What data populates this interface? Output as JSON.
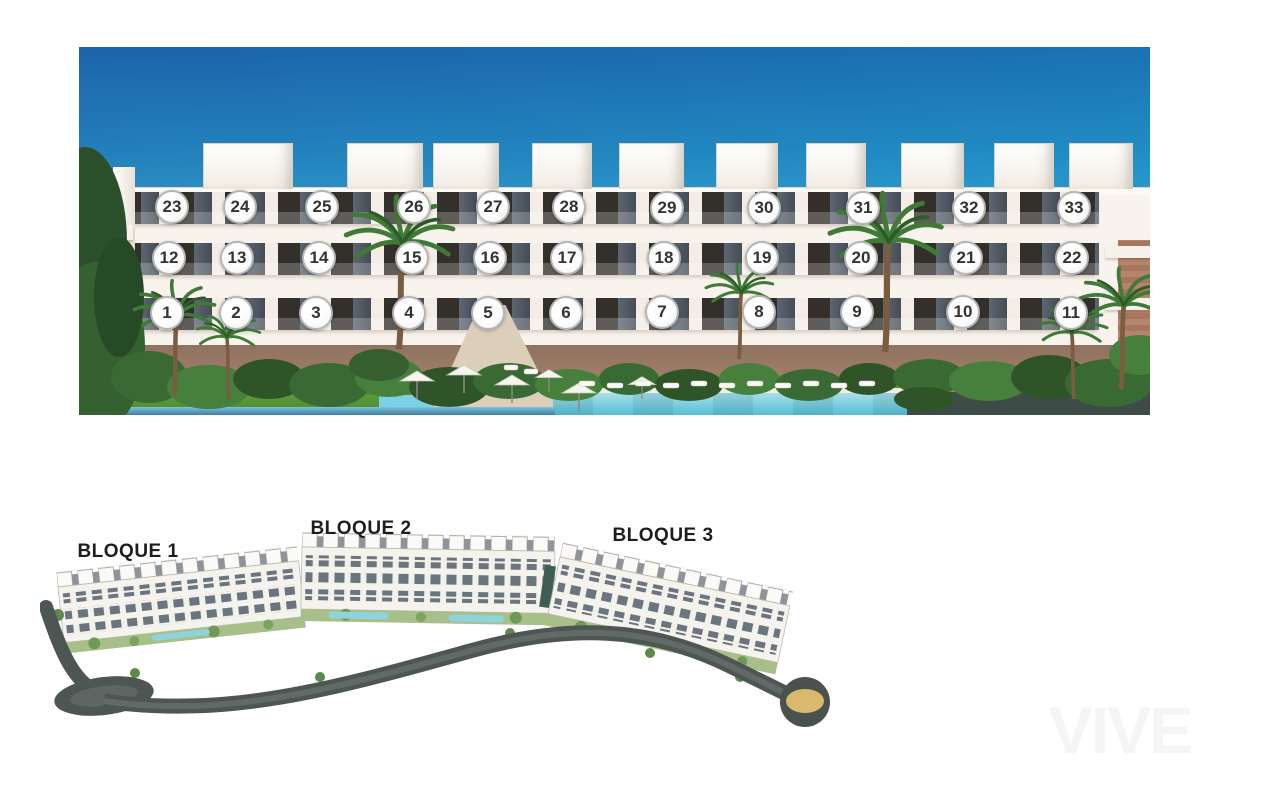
{
  "elevation": {
    "rows": [
      {
        "floor": "top",
        "units": [
          {
            "n": "23",
            "x": 93,
            "y": 160
          },
          {
            "n": "24",
            "x": 161,
            "y": 160
          },
          {
            "n": "25",
            "x": 243,
            "y": 160
          },
          {
            "n": "26",
            "x": 335,
            "y": 160
          },
          {
            "n": "27",
            "x": 414,
            "y": 160
          },
          {
            "n": "28",
            "x": 490,
            "y": 160
          },
          {
            "n": "29",
            "x": 588,
            "y": 161
          },
          {
            "n": "30",
            "x": 685,
            "y": 161
          },
          {
            "n": "31",
            "x": 784,
            "y": 161
          },
          {
            "n": "32",
            "x": 890,
            "y": 161
          },
          {
            "n": "33",
            "x": 995,
            "y": 161
          }
        ]
      },
      {
        "floor": "middle",
        "units": [
          {
            "n": "12",
            "x": 90,
            "y": 211
          },
          {
            "n": "13",
            "x": 158,
            "y": 211
          },
          {
            "n": "14",
            "x": 240,
            "y": 211
          },
          {
            "n": "15",
            "x": 333,
            "y": 211
          },
          {
            "n": "16",
            "x": 411,
            "y": 211
          },
          {
            "n": "17",
            "x": 488,
            "y": 211
          },
          {
            "n": "18",
            "x": 585,
            "y": 211
          },
          {
            "n": "19",
            "x": 683,
            "y": 211
          },
          {
            "n": "20",
            "x": 782,
            "y": 211
          },
          {
            "n": "21",
            "x": 887,
            "y": 211
          },
          {
            "n": "22",
            "x": 993,
            "y": 211
          }
        ]
      },
      {
        "floor": "ground",
        "units": [
          {
            "n": "1",
            "x": 88,
            "y": 266
          },
          {
            "n": "2",
            "x": 157,
            "y": 266
          },
          {
            "n": "3",
            "x": 237,
            "y": 266
          },
          {
            "n": "4",
            "x": 330,
            "y": 266
          },
          {
            "n": "5",
            "x": 409,
            "y": 266
          },
          {
            "n": "6",
            "x": 487,
            "y": 266
          },
          {
            "n": "7",
            "x": 583,
            "y": 265
          },
          {
            "n": "8",
            "x": 680,
            "y": 265
          },
          {
            "n": "9",
            "x": 778,
            "y": 265
          },
          {
            "n": "10",
            "x": 884,
            "y": 265
          },
          {
            "n": "11",
            "x": 992,
            "y": 266
          }
        ]
      }
    ]
  },
  "site_plan": {
    "blocks": [
      {
        "label": "BLOQUE 1",
        "x": 88,
        "y": 47
      },
      {
        "label": "BLOQUE 2",
        "x": 321,
        "y": 24
      },
      {
        "label": "BLOQUE 3",
        "x": 623,
        "y": 31
      }
    ]
  },
  "watermark": {
    "text": "VIVE"
  },
  "colors": {
    "sky_top": "#1e66ad",
    "sky_bottom": "#8adcee",
    "marker_fill": "#fdfdfd",
    "marker_border": "#b5b5b5",
    "marker_text": "#333333",
    "pool": "#56bed4",
    "road": "#4d5653",
    "roundabout_gold": "#d9b96b",
    "label_text": "#1d1d1d",
    "deck": "#3e4c47"
  }
}
